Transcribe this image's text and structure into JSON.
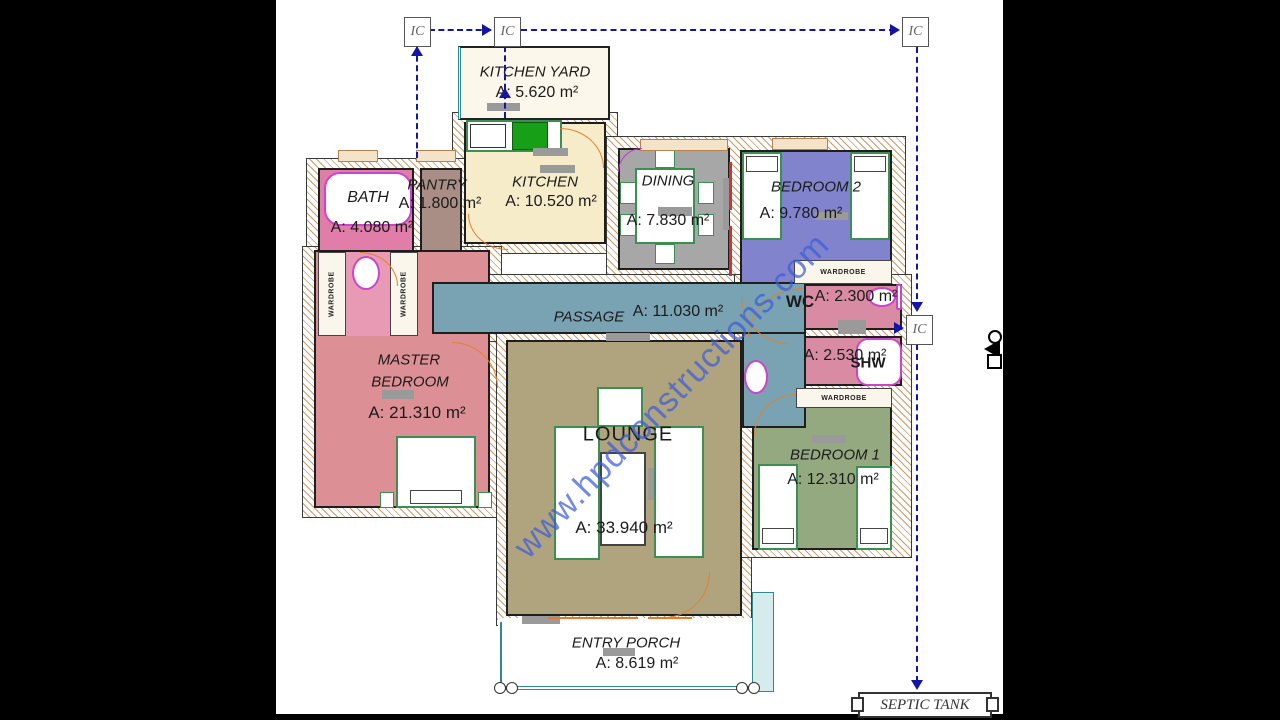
{
  "watermark": {
    "text": "www.hpdconstructions.com"
  },
  "markers": {
    "ic_label": "IC",
    "septic_tank_label": "SEPTIC TANK",
    "wardrobe_label": "WARDROBE"
  },
  "rooms": {
    "kitchen_yard": {
      "name": "KITCHEN YARD",
      "area": "A: 5.620 m²",
      "fill": "#fbf7ea"
    },
    "bath": {
      "name": "BATH",
      "area": "A: 4.080 m²",
      "fill": "#e07da8"
    },
    "pantry": {
      "name": "PANTRY",
      "area": "A: 1.800 m²",
      "fill": "#a98e85"
    },
    "kitchen": {
      "name": "KITCHEN",
      "area": "A: 10.520 m²",
      "fill": "#f6ecca"
    },
    "dining": {
      "name": "DINING",
      "area": "A: 7.830 m²",
      "fill": "#a7a7a7"
    },
    "bedroom2": {
      "name": "BEDROOM 2",
      "area": "A: 9.780 m²",
      "fill": "#8184cd"
    },
    "wc": {
      "name": "WC",
      "area": "A: 2.300 m²",
      "fill": "#d98ba4"
    },
    "shw": {
      "name": "SHW",
      "area": "A: 2.530 m²",
      "fill": "#d98ba4"
    },
    "passage": {
      "name": "PASSAGE",
      "area": "A: 11.030 m²",
      "fill": "#79a2b2"
    },
    "master_bedroom": {
      "name_line1": "MASTER",
      "name_line2": "BEDROOM",
      "area": "A: 21.310 m²",
      "fill": "#dc9096"
    },
    "lounge": {
      "name": "LOUNGE",
      "area": "A: 33.940 m²",
      "fill": "#b0a47e"
    },
    "bedroom1": {
      "name": "BEDROOM 1",
      "area": "A: 12.310 m²",
      "fill": "#95a981"
    },
    "entry_porch": {
      "name": "ENTRY PORCH",
      "area": "A: 8.619 m²",
      "fill": "#ffffff"
    }
  }
}
